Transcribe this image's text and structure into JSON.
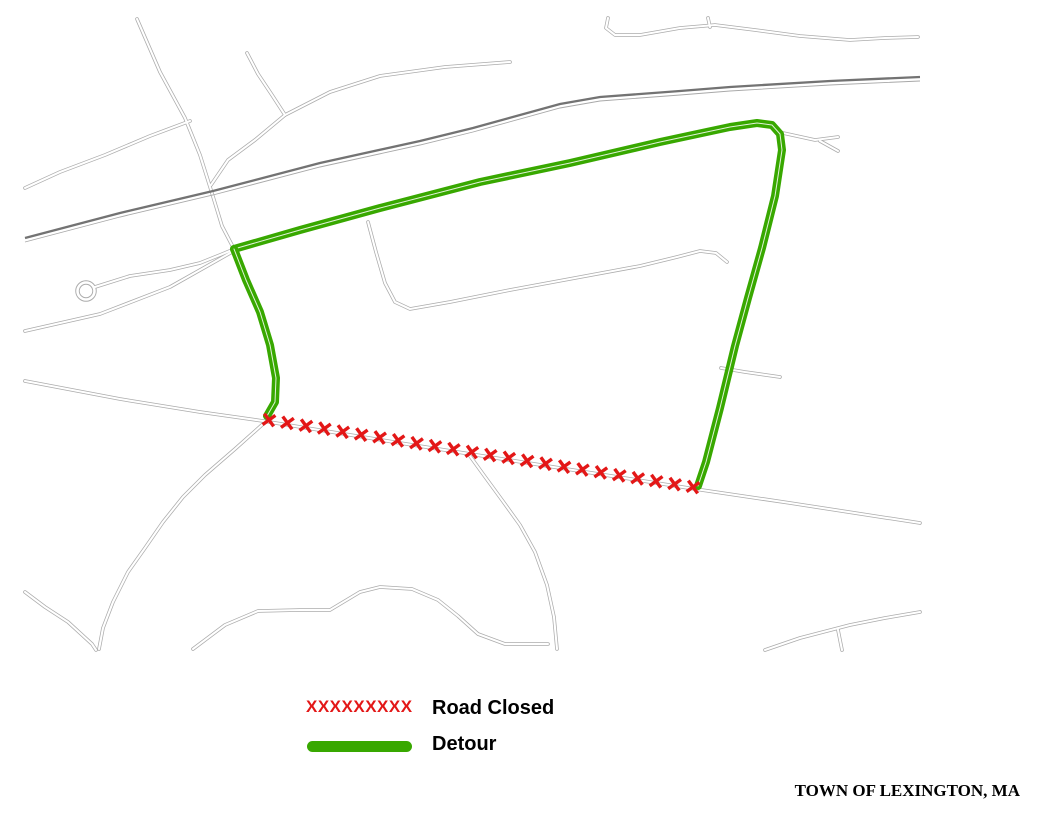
{
  "map": {
    "frame": {
      "x": 24,
      "y": 18,
      "w": 896,
      "h": 632
    },
    "colors": {
      "road_casing": "#ababab",
      "road_fill": "#ffffff",
      "railroad": "#737373",
      "railroad_thin": "#a8a8a8",
      "detour": "#38A800",
      "closed": "#e31717",
      "label": "#000000",
      "frame": "#000000"
    },
    "roads": [
      {
        "name": "russell-street",
        "pts": [
          [
            137,
            19
          ],
          [
            160,
            72
          ],
          [
            185,
            118
          ],
          [
            200,
            155
          ],
          [
            211,
            190
          ],
          [
            222,
            226
          ],
          [
            234,
            249
          ]
        ]
      },
      {
        "name": "grant-street",
        "pts": [
          [
            25,
            188
          ],
          [
            60,
            172
          ],
          [
            105,
            155
          ],
          [
            150,
            136
          ],
          [
            190,
            121
          ]
        ]
      },
      {
        "name": "hampshire-circle",
        "pts": [
          [
            247,
            53
          ],
          [
            258,
            74
          ],
          [
            272,
            95
          ],
          [
            285,
            115
          ]
        ]
      },
      {
        "name": "parliament-lane",
        "pts": [
          [
            285,
            115
          ],
          [
            330,
            92
          ],
          [
            380,
            76
          ],
          [
            445,
            67
          ],
          [
            510,
            62
          ]
        ]
      },
      {
        "name": "parliament-connector",
        "pts": [
          [
            285,
            115
          ],
          [
            255,
            140
          ],
          [
            228,
            160
          ],
          [
            211,
            185
          ]
        ]
      },
      {
        "name": "robinson-road",
        "pts": [
          [
            608,
            18
          ],
          [
            606,
            28
          ],
          [
            615,
            35
          ],
          [
            640,
            35
          ],
          [
            680,
            28
          ],
          [
            715,
            25
          ],
          [
            755,
            30
          ],
          [
            800,
            36
          ],
          [
            850,
            40
          ],
          [
            885,
            38
          ],
          [
            918,
            37
          ]
        ]
      },
      {
        "name": "robinson-stub",
        "pts": [
          [
            708,
            18
          ],
          [
            710,
            27
          ]
        ]
      },
      {
        "name": "cooke-road",
        "pts": [
          [
            368,
            222
          ],
          [
            376,
            252
          ],
          [
            385,
            283
          ],
          [
            395,
            302
          ],
          [
            410,
            309
          ],
          [
            450,
            302
          ],
          [
            510,
            290
          ],
          [
            575,
            278
          ],
          [
            640,
            266
          ],
          [
            677,
            257
          ],
          [
            700,
            251
          ],
          [
            716,
            253
          ],
          [
            727,
            262
          ]
        ]
      },
      {
        "name": "rolfe-road",
        "pts": [
          [
            721,
            368
          ],
          [
            745,
            372
          ],
          [
            780,
            377
          ]
        ]
      },
      {
        "name": "lowell-street",
        "pts": [
          [
            25,
            381
          ],
          [
            120,
            399
          ],
          [
            200,
            412
          ],
          [
            263,
            421
          ],
          [
            400,
            443
          ],
          [
            560,
            468
          ],
          [
            695,
            489
          ],
          [
            790,
            503
          ],
          [
            920,
            523
          ]
        ]
      },
      {
        "name": "east-street",
        "pts": [
          [
            263,
            424
          ],
          [
            235,
            449
          ],
          [
            205,
            475
          ],
          [
            183,
            497
          ],
          [
            163,
            522
          ],
          [
            145,
            548
          ],
          [
            128,
            572
          ],
          [
            113,
            602
          ],
          [
            103,
            628
          ],
          [
            99,
            649
          ]
        ]
      },
      {
        "name": "burroughs-road",
        "pts": [
          [
            25,
            592
          ],
          [
            45,
            607
          ],
          [
            68,
            622
          ],
          [
            92,
            644
          ],
          [
            96,
            650
          ]
        ]
      },
      {
        "name": "ridge-road",
        "pts": [
          [
            193,
            649
          ],
          [
            225,
            625
          ],
          [
            258,
            611
          ],
          [
            300,
            610
          ],
          [
            330,
            610
          ],
          [
            360,
            592
          ],
          [
            380,
            587
          ],
          [
            412,
            589
          ],
          [
            438,
            600
          ],
          [
            458,
            616
          ],
          [
            478,
            634
          ],
          [
            505,
            644
          ],
          [
            548,
            644
          ]
        ]
      },
      {
        "name": "laconia-street",
        "pts": [
          [
            470,
            456
          ],
          [
            483,
            474
          ],
          [
            502,
            500
          ],
          [
            520,
            525
          ],
          [
            535,
            552
          ],
          [
            547,
            585
          ],
          [
            554,
            617
          ],
          [
            557,
            649
          ]
        ]
      },
      {
        "name": "bottom-right-road",
        "pts": [
          [
            765,
            650
          ],
          [
            800,
            638
          ],
          [
            850,
            625
          ],
          [
            885,
            618
          ],
          [
            920,
            612
          ]
        ]
      },
      {
        "name": "bottom-right-branch",
        "pts": [
          [
            838,
            630
          ],
          [
            842,
            650
          ]
        ]
      },
      {
        "name": "cul-de-sac-road",
        "pts": [
          [
            95,
            287
          ],
          [
            130,
            276
          ],
          [
            170,
            270
          ],
          [
            200,
            263
          ],
          [
            220,
            255
          ],
          [
            232,
            250
          ]
        ]
      },
      {
        "name": "junction-west-road",
        "pts": [
          [
            232,
            252
          ],
          [
            170,
            287
          ],
          [
            100,
            314
          ],
          [
            25,
            331
          ]
        ]
      },
      {
        "name": "fulton-east-stub",
        "pts": [
          [
            783,
            133
          ],
          [
            815,
            140
          ],
          [
            838,
            137
          ]
        ]
      },
      {
        "name": "fulton-east-stub-branch",
        "pts": [
          [
            820,
            141
          ],
          [
            838,
            151
          ]
        ]
      }
    ],
    "cul_de_sac": {
      "cx": 86,
      "cy": 291,
      "r": 8.5
    },
    "railroad": {
      "pts": [
        [
          25,
          238
        ],
        [
          120,
          213
        ],
        [
          213,
          191
        ],
        [
          320,
          163
        ],
        [
          420,
          141
        ],
        [
          473,
          128
        ],
        [
          560,
          104
        ],
        [
          600,
          97
        ],
        [
          680,
          91
        ],
        [
          730,
          87
        ],
        [
          830,
          81
        ],
        [
          920,
          77
        ]
      ]
    },
    "detour_routes": [
      {
        "name": "detour-douglas-fulton",
        "pts": [
          [
            234,
            249
          ],
          [
            300,
            230
          ],
          [
            380,
            208
          ],
          [
            480,
            182
          ],
          [
            570,
            163
          ],
          [
            660,
            142
          ],
          [
            730,
            127
          ],
          [
            757,
            123
          ],
          [
            772,
            125
          ],
          [
            780,
            134
          ],
          [
            782,
            150
          ],
          [
            775,
            196
          ],
          [
            762,
            248
          ],
          [
            748,
            298
          ],
          [
            735,
            346
          ],
          [
            720,
            408
          ],
          [
            706,
            462
          ],
          [
            698,
            486
          ]
        ]
      },
      {
        "name": "detour-west-connector",
        "pts": [
          [
            234,
            249
          ],
          [
            246,
            280
          ],
          [
            260,
            312
          ],
          [
            270,
            345
          ],
          [
            276,
            378
          ],
          [
            275,
            402
          ],
          [
            267,
            416
          ]
        ]
      }
    ],
    "closure": {
      "name": "lowell-street-closed",
      "from": [
        269,
        420
      ],
      "to": [
        693,
        487
      ],
      "count": 24,
      "size": 5.6,
      "stroke_width": 3.4
    },
    "labels": [
      {
        "id": "grant-street",
        "text": "GRANT STREET",
        "x": 99,
        "y": 151,
        "rot": -21
      },
      {
        "id": "russell-street",
        "text": "RUSSELL STREET",
        "x": 177,
        "y": 104,
        "rot": 60
      },
      {
        "id": "hampshire",
        "text": "HAMPSHIRE",
        "x": 271,
        "y": 80,
        "rot": 60
      },
      {
        "id": "circle",
        "text": "CIRCLE",
        "x": 253,
        "y": 92,
        "rot": 56
      },
      {
        "id": "parliament-lane",
        "text": "PARLIAMENT LANE",
        "x": 340,
        "y": 68,
        "rot": -7
      },
      {
        "id": "robinson-road",
        "text": "ROBINSON ROAD",
        "x": 868,
        "y": 26,
        "rot": 5
      },
      {
        "id": "douglas-road",
        "text": "DOUGLAS ROAD",
        "x": 531,
        "y": 163,
        "rot": -14
      },
      {
        "id": "cooke-road",
        "text": "COOKE ROAD",
        "x": 528,
        "y": 276,
        "rot": -12
      },
      {
        "id": "fulton-road",
        "text": "FULTON ROAD",
        "x": 728,
        "y": 295,
        "rot": -65
      },
      {
        "id": "rolfe",
        "text": "ROLFE",
        "x": 752,
        "y": 364,
        "rot": -6
      },
      {
        "id": "rolfe-road-2",
        "text": "ROAD",
        "x": 748,
        "y": 385,
        "rot": -6
      },
      {
        "id": "lowell-street",
        "text": "LOWELL STREET",
        "x": 483,
        "y": 442,
        "rot": 9
      },
      {
        "id": "east-street",
        "text": "EAST STREET",
        "x": 212,
        "y": 455,
        "rot": -47
      },
      {
        "id": "laconia-street",
        "text": "LACONIA STREET",
        "x": 543,
        "y": 538,
        "rot": 58
      },
      {
        "id": "ridge",
        "text": "RIDGE",
        "x": 401,
        "y": 578,
        "rot": 0
      },
      {
        "id": "ridge-road-2",
        "text": "ROAD",
        "x": 400,
        "y": 602,
        "rot": 0
      },
      {
        "id": "burroughs",
        "text": "BURROUGHS",
        "x": 61,
        "y": 616,
        "rot": 38
      },
      {
        "id": "burroughs-road-2",
        "text": "ROAD",
        "x": 45,
        "y": 636,
        "rot": 38
      }
    ],
    "label_style": {
      "size": 10,
      "letter_spacing": 1.1
    },
    "compass": {
      "cx": 983,
      "cy": 65,
      "rot": -40,
      "point_len": 22,
      "letter_r": 27,
      "letters": {
        "n": "N",
        "e": "E",
        "s": "S",
        "w": "W"
      }
    }
  },
  "legend": {
    "closed_symbol": "XXXXXXXXX",
    "closed_label": "Road Closed",
    "detour_label": "Detour"
  },
  "footer": {
    "title": "TOWN OF LEXINGTON, MA"
  }
}
